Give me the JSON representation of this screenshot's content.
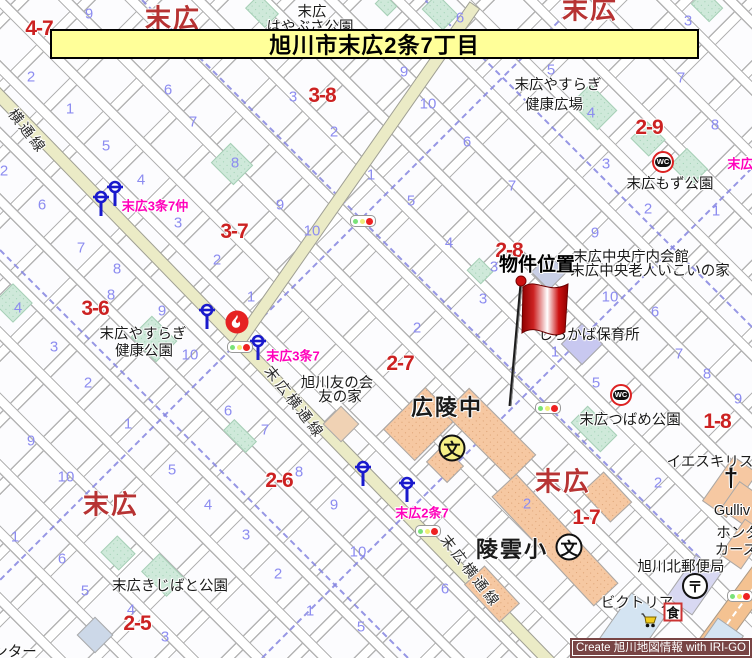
{
  "banner": {
    "title": "旭川市末広2条7丁目",
    "bg": "#ffff99"
  },
  "credit": {
    "text": "Create 旭川地図情報 with IRI-GO",
    "bg": "#784444"
  },
  "colors": {
    "main_road": "#ebebc6",
    "orange_road": "#f4c291",
    "park": "#cfe9da",
    "building": "#f6c8a2",
    "boundary_dash": "#8585e0",
    "lot_number": "#8c8cf0",
    "block_label": "#cc2222",
    "district_label": "#b73333",
    "busstop_label": "#ff00bb",
    "flag": "#cc0000"
  },
  "map": {
    "property_marker": {
      "label": "物件位置",
      "label_x": 537,
      "label_y": 263,
      "flag_x": 498,
      "flag_y": 270,
      "flag_w": 80,
      "flag_h": 140
    },
    "district_labels": [
      {
        "text": "末広",
        "x": 173,
        "y": 17
      },
      {
        "text": "末広",
        "x": 590,
        "y": 8
      },
      {
        "text": "末広",
        "x": 111,
        "y": 503
      },
      {
        "text": "末広",
        "x": 563,
        "y": 480
      }
    ],
    "block_labels": [
      {
        "text": "4-7",
        "x": 39,
        "y": 29
      },
      {
        "text": "3-8",
        "x": 322,
        "y": 96
      },
      {
        "text": "3-7",
        "x": 234,
        "y": 232
      },
      {
        "text": "3-6",
        "x": 95,
        "y": 309
      },
      {
        "text": "2-9",
        "x": 649,
        "y": 128
      },
      {
        "text": "2-8",
        "x": 509,
        "y": 251
      },
      {
        "text": "2-7",
        "x": 400,
        "y": 364
      },
      {
        "text": "1-8",
        "x": 717,
        "y": 422
      },
      {
        "text": "2-6",
        "x": 279,
        "y": 481
      },
      {
        "text": "1-7",
        "x": 586,
        "y": 518
      },
      {
        "text": "2-5",
        "x": 137,
        "y": 624
      }
    ],
    "place_labels": [
      {
        "text": "末広",
        "x": 312,
        "y": 11
      },
      {
        "text": "はやぶさ公園",
        "x": 310,
        "y": 26
      },
      {
        "text": "末広やすらぎ",
        "x": 558,
        "y": 84
      },
      {
        "text": "健康広場",
        "x": 554,
        "y": 104
      },
      {
        "text": "末広もず公園",
        "x": 670,
        "y": 183
      },
      {
        "text": "末広中央庁内会館",
        "x": 631,
        "y": 256
      },
      {
        "text": "末広中央老人いこいの家",
        "x": 650,
        "y": 270
      },
      {
        "text": "しらかば保育所",
        "x": 589,
        "y": 334
      },
      {
        "text": "旭川友の会",
        "x": 337,
        "y": 382
      },
      {
        "text": "友の家",
        "x": 340,
        "y": 396
      },
      {
        "text": "末広やすらぎ",
        "x": 143,
        "y": 333
      },
      {
        "text": "健康公園",
        "x": 144,
        "y": 350
      },
      {
        "text": "末広つばめ公園",
        "x": 630,
        "y": 419
      },
      {
        "text": "イエスキリス",
        "x": 710,
        "y": 461
      },
      {
        "text": "Gulliv",
        "x": 732,
        "y": 511
      },
      {
        "text": "ホンダ",
        "x": 738,
        "y": 532
      },
      {
        "text": "カーズ",
        "x": 736,
        "y": 549
      },
      {
        "text": "旭川北郵便局",
        "x": 681,
        "y": 566
      },
      {
        "text": "ビクトリア",
        "x": 637,
        "y": 602
      },
      {
        "text": "末広きじばと公園",
        "x": 170,
        "y": 585
      },
      {
        "text": "ンター",
        "x": 15,
        "y": 651
      }
    ],
    "school_labels": [
      {
        "text": "広陵中",
        "x": 447,
        "y": 406
      },
      {
        "text": "陵雲小",
        "x": 512,
        "y": 548
      }
    ],
    "street_labels": [
      {
        "text": "横通線",
        "x": 28,
        "y": 131,
        "rot": 52
      },
      {
        "text": "末広横通線",
        "x": 295,
        "y": 402,
        "rot": 52
      },
      {
        "text": "末広横通線",
        "x": 471,
        "y": 571,
        "rot": 52
      }
    ],
    "busstop_labels": [
      {
        "text": "末広3条7仲",
        "x": 155,
        "y": 205
      },
      {
        "text": "末広3条7",
        "x": 293,
        "y": 355
      },
      {
        "text": "末広2条7",
        "x": 422,
        "y": 512
      },
      {
        "text": "末広2",
        "x": 744,
        "y": 163
      }
    ],
    "lot_numbers": [
      {
        "n": "9",
        "x": 89,
        "y": 14
      },
      {
        "n": "2",
        "x": 31,
        "y": 77
      },
      {
        "n": "6",
        "x": 168,
        "y": 90
      },
      {
        "n": "1",
        "x": 70,
        "y": 109
      },
      {
        "n": "7",
        "x": 193,
        "y": 122
      },
      {
        "n": "5",
        "x": 106,
        "y": 146
      },
      {
        "n": "4",
        "x": 141,
        "y": 180
      },
      {
        "n": "2",
        "x": 4,
        "y": 171
      },
      {
        "n": "6",
        "x": 42,
        "y": 205
      },
      {
        "n": "8",
        "x": 235,
        "y": 163
      },
      {
        "n": "9",
        "x": 280,
        "y": 205
      },
      {
        "n": "3",
        "x": 293,
        "y": 97
      },
      {
        "n": "2",
        "x": 334,
        "y": 132
      },
      {
        "n": "1",
        "x": 371,
        "y": 175
      },
      {
        "n": "6",
        "x": 460,
        "y": 18
      },
      {
        "n": "3",
        "x": 688,
        "y": 21
      },
      {
        "n": "9",
        "x": 404,
        "y": 72
      },
      {
        "n": "10",
        "x": 428,
        "y": 104
      },
      {
        "n": "5",
        "x": 551,
        "y": 70
      },
      {
        "n": "7",
        "x": 681,
        "y": 78
      },
      {
        "n": "6",
        "x": 467,
        "y": 142
      },
      {
        "n": "4",
        "x": 591,
        "y": 113
      },
      {
        "n": "8",
        "x": 715,
        "y": 125
      },
      {
        "n": "3",
        "x": 606,
        "y": 164
      },
      {
        "n": "7",
        "x": 512,
        "y": 186
      },
      {
        "n": "5",
        "x": 411,
        "y": 201
      },
      {
        "n": "2",
        "x": 648,
        "y": 209
      },
      {
        "n": "1",
        "x": 716,
        "y": 211
      },
      {
        "n": "3",
        "x": 178,
        "y": 223
      },
      {
        "n": "10",
        "x": 312,
        "y": 231
      },
      {
        "n": "2",
        "x": 217,
        "y": 260
      },
      {
        "n": "7",
        "x": 81,
        "y": 248
      },
      {
        "n": "8",
        "x": 117,
        "y": 269
      },
      {
        "n": "8",
        "x": 111,
        "y": 295
      },
      {
        "n": "4",
        "x": 18,
        "y": 308
      },
      {
        "n": "9",
        "x": 162,
        "y": 311
      },
      {
        "n": "1",
        "x": 251,
        "y": 297
      },
      {
        "n": "3",
        "x": 54,
        "y": 347
      },
      {
        "n": "10",
        "x": 190,
        "y": 355
      },
      {
        "n": "2",
        "x": 88,
        "y": 383
      },
      {
        "n": "6",
        "x": 228,
        "y": 411
      },
      {
        "n": "1",
        "x": 128,
        "y": 424
      },
      {
        "n": "7",
        "x": 265,
        "y": 430
      },
      {
        "n": "4",
        "x": 449,
        "y": 243
      },
      {
        "n": "9",
        "x": 595,
        "y": 233
      },
      {
        "n": "3",
        "x": 494,
        "y": 267
      },
      {
        "n": "3",
        "x": 483,
        "y": 299
      },
      {
        "n": "10",
        "x": 610,
        "y": 297
      },
      {
        "n": "6",
        "x": 655,
        "y": 312
      },
      {
        "n": "2",
        "x": 417,
        "y": 328
      },
      {
        "n": "1",
        "x": 555,
        "y": 352
      },
      {
        "n": "5",
        "x": 596,
        "y": 383
      },
      {
        "n": "7",
        "x": 679,
        "y": 354
      },
      {
        "n": "8",
        "x": 707,
        "y": 374
      },
      {
        "n": "9",
        "x": 738,
        "y": 399
      },
      {
        "n": "9",
        "x": 31,
        "y": 441
      },
      {
        "n": "10",
        "x": 66,
        "y": 477
      },
      {
        "n": "5",
        "x": 172,
        "y": 470
      },
      {
        "n": "4",
        "x": 208,
        "y": 505
      },
      {
        "n": "1",
        "x": 15,
        "y": 537
      },
      {
        "n": "6",
        "x": 62,
        "y": 559
      },
      {
        "n": "3",
        "x": 246,
        "y": 535
      },
      {
        "n": "5",
        "x": 85,
        "y": 591
      },
      {
        "n": "2",
        "x": 278,
        "y": 574
      },
      {
        "n": "4",
        "x": 131,
        "y": 610
      },
      {
        "n": "1",
        "x": 310,
        "y": 611
      },
      {
        "n": "10",
        "x": 358,
        "y": 552
      },
      {
        "n": "9",
        "x": 334,
        "y": 505
      },
      {
        "n": "8",
        "x": 299,
        "y": 472
      },
      {
        "n": "5",
        "x": 361,
        "y": 627
      },
      {
        "n": "3",
        "x": 165,
        "y": 637
      },
      {
        "n": "2",
        "x": 527,
        "y": 504
      },
      {
        "n": "2",
        "x": 658,
        "y": 483
      },
      {
        "n": "6",
        "x": 445,
        "y": 589
      }
    ],
    "roads": [
      {
        "x1": -30,
        "y1": 65,
        "x2": 560,
        "y2": 672,
        "w": 13,
        "kind": "yellow"
      },
      {
        "x1": 237,
        "y1": 345,
        "x2": 475,
        "y2": 5,
        "w": 13,
        "kind": "yellow"
      },
      {
        "x1": 688,
        "y1": 675,
        "x2": 768,
        "y2": 566,
        "w": 26,
        "kind": "orange",
        "dash": true
      }
    ],
    "boundary_lines": [
      {
        "x1": 142,
        "y1": 0,
        "x2": 700,
        "y2": 558
      },
      {
        "x1": 0,
        "y1": 250,
        "x2": 408,
        "y2": 658
      },
      {
        "x1": 580,
        "y1": 0,
        "x2": 0,
        "y2": 580
      },
      {
        "x1": 752,
        "y1": 168,
        "x2": 262,
        "y2": 658
      },
      {
        "x1": 425,
        "y1": 0,
        "x2": 752,
        "y2": 327
      }
    ],
    "parks": [
      {
        "x": 232,
        "y": 164,
        "w": 32,
        "h": 28
      },
      {
        "x": 594,
        "y": 107,
        "w": 38,
        "h": 28
      },
      {
        "x": 648,
        "y": 139,
        "w": 26,
        "h": 24
      },
      {
        "x": 689,
        "y": 167,
        "w": 30,
        "h": 24
      },
      {
        "x": 480,
        "y": 271,
        "w": 20,
        "h": 18
      },
      {
        "x": 154,
        "y": 339,
        "w": 36,
        "h": 30
      },
      {
        "x": 13,
        "y": 303,
        "w": 28,
        "h": 28
      },
      {
        "x": 118,
        "y": 553,
        "w": 26,
        "h": 24
      },
      {
        "x": 163,
        "y": 575,
        "w": 36,
        "h": 26
      },
      {
        "x": 240,
        "y": 436,
        "w": 32,
        "h": 16
      },
      {
        "x": 594,
        "y": 429,
        "w": 42,
        "h": 24
      },
      {
        "x": 262,
        "y": 11,
        "w": 28,
        "h": 20
      },
      {
        "x": 440,
        "y": 12,
        "w": 30,
        "h": 22
      },
      {
        "x": 707,
        "y": 6,
        "w": 26,
        "h": 20
      },
      {
        "x": 386,
        "y": 5,
        "w": 18,
        "h": 14
      }
    ],
    "buildings": [
      {
        "x": 420,
        "y": 424,
        "w": 60,
        "h": 45,
        "rot": -45
      },
      {
        "x": 490,
        "y": 434,
        "w": 95,
        "h": 36,
        "rot": 45
      },
      {
        "x": 445,
        "y": 464,
        "w": 30,
        "h": 24,
        "rot": 45
      },
      {
        "x": 555,
        "y": 540,
        "w": 150,
        "h": 34,
        "rot": 47
      },
      {
        "x": 607,
        "y": 497,
        "w": 42,
        "h": 30,
        "rot": 47
      },
      {
        "x": 492,
        "y": 594,
        "w": 52,
        "h": 28,
        "rot": 47
      },
      {
        "x": 341,
        "y": 424,
        "w": 26,
        "h": 26,
        "rot": 45,
        "fill": "#f0d2b4",
        "plain": true
      },
      {
        "x": 730,
        "y": 487,
        "w": 55,
        "h": 30,
        "rot": -55,
        "plain": true
      },
      {
        "x": 747,
        "y": 507,
        "w": 34,
        "h": 42,
        "rot": -55,
        "plain": true
      },
      {
        "x": 743,
        "y": 544,
        "w": 44,
        "h": 26,
        "rot": -55,
        "plain": true
      },
      {
        "x": 694,
        "y": 585,
        "w": 52,
        "h": 32,
        "rot": -55,
        "fill": "#d8d8f2",
        "plain": true
      },
      {
        "x": 582,
        "y": 344,
        "w": 30,
        "h": 30,
        "rot": 45,
        "fill": "#c8c8f0",
        "plain": true
      },
      {
        "x": 549,
        "y": 272,
        "w": 26,
        "h": 26,
        "rot": 45,
        "fill": "#c9cfe6",
        "plain": true
      },
      {
        "x": 632,
        "y": 628,
        "w": 58,
        "h": 42,
        "rot": -55,
        "fill": "#d4e4f2",
        "plain": true
      },
      {
        "x": 716,
        "y": 648,
        "w": 52,
        "h": 32,
        "rot": -55,
        "fill": "#d4e4f2",
        "plain": true
      },
      {
        "x": 95,
        "y": 635,
        "w": 26,
        "h": 26,
        "rot": 45,
        "fill": "#ccd8e8",
        "plain": true
      }
    ],
    "icons": [
      {
        "type": "bus-stop",
        "x": 101,
        "y": 206
      },
      {
        "type": "bus-stop",
        "x": 115,
        "y": 196
      },
      {
        "type": "bus-stop",
        "x": 207,
        "y": 319
      },
      {
        "type": "bus-stop",
        "x": 258,
        "y": 350
      },
      {
        "type": "bus-stop",
        "x": 363,
        "y": 476
      },
      {
        "type": "bus-stop",
        "x": 407,
        "y": 492
      },
      {
        "type": "traffic-light",
        "x": 240,
        "y": 347
      },
      {
        "type": "traffic-light",
        "x": 363,
        "y": 221
      },
      {
        "type": "traffic-light",
        "x": 428,
        "y": 531
      },
      {
        "type": "traffic-light",
        "x": 548,
        "y": 408
      },
      {
        "type": "traffic-light",
        "x": 740,
        "y": 596
      },
      {
        "type": "wc",
        "x": 663,
        "y": 162
      },
      {
        "type": "wc",
        "x": 621,
        "y": 395
      },
      {
        "type": "fire",
        "x": 237,
        "y": 322
      },
      {
        "type": "school-yellow",
        "x": 452,
        "y": 448
      },
      {
        "type": "school-white",
        "x": 569,
        "y": 547
      },
      {
        "type": "post",
        "x": 695,
        "y": 586
      },
      {
        "type": "church-cross",
        "x": 731,
        "y": 478
      },
      {
        "type": "restaurant",
        "x": 673,
        "y": 612
      },
      {
        "type": "cart",
        "x": 650,
        "y": 623
      }
    ],
    "icon_glyphs": {
      "school": "文",
      "post": "〒",
      "restaurant": "食",
      "wc": "WC",
      "church": "†"
    }
  }
}
